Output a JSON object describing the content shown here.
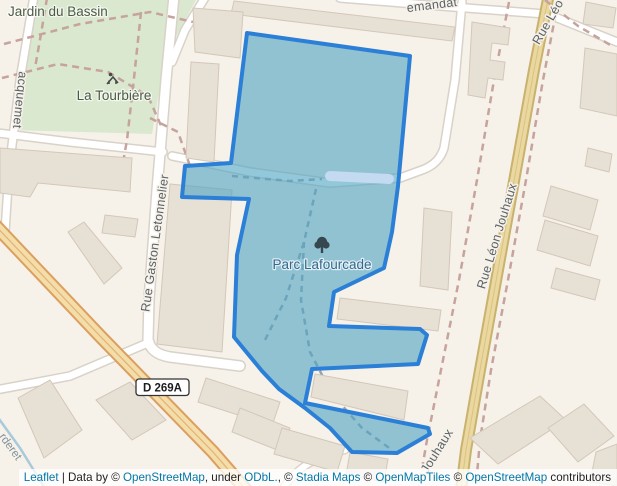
{
  "map": {
    "labels": {
      "jardin_du_bassin": "Jardin du Bassin",
      "la_tourbiere": "La Tourbière",
      "parc_lafourcade": "Parc Lafourcade",
      "rue_gaston_letonnelier": "Rue Gaston Letonnelier",
      "rue_leon_jouhaux": "Rue Léon Jouhaux",
      "jouhaux": "Jouhaux",
      "rue_leo_partial": "Rue Léo",
      "emandat_partial": "emandat",
      "acquemet_partial": "acquemet",
      "rderet_partial": "rderet",
      "road_ref": "D 269A"
    },
    "highlight": {
      "name": "Parc Lafourcade",
      "points": "247,33 410,56 398,186 392,232 384,268 334,292 329,326 420,329 427,335 418,364 312,369 305,403 428,428 430,434 397,453 352,452 330,428 305,408 279,389 262,371 234,337 237,255 249,199 182,197 185,166 231,163",
      "stroke": "#2b7fd6",
      "fill": "rgba(80,165,196,0.62)"
    },
    "colors": {
      "background": "#f6f2ea",
      "park_green": "#d9e8cf",
      "building": "#e7e0d5",
      "building_outline": "#d3c7b8",
      "road_fill": "#ffffff",
      "road_casing": "#d8d2c8",
      "primary_road_fill": "#f3dda8",
      "primary_road_casing": "#dc9f60",
      "avenue_fill": "#ead8a0",
      "avenue_casing": "#c9b26e",
      "water_band": "#c3daf0",
      "stream": "#a8cadb",
      "path_dash_brown": "#c6a39c",
      "path_dash_gray": "#98a4ae",
      "street_label": "#5b6166",
      "park_label": "#4d5a44",
      "highlight_label": "#34688f",
      "link_blue": "#0078a8"
    }
  },
  "attribution": {
    "a1": "Leaflet",
    "a2": " | Data by © ",
    "a3": "OpenStreetMap",
    "a4": ", under ",
    "a5": "ODbL.",
    "a6": ", © ",
    "a7": "Stadia Maps",
    "a8": " © ",
    "a9": "OpenMapTiles",
    "a10": " © ",
    "a11": "OpenStreetMap",
    "a12": " contributors"
  }
}
